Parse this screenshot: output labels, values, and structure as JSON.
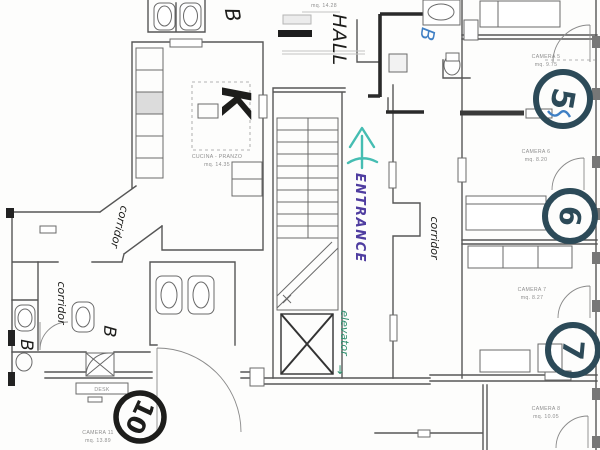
{
  "annotations": {
    "kitchen": "K",
    "hall": "HALL",
    "entrance": "ENTRANCE",
    "elevator": "elevator",
    "elevator_arrow": "↓",
    "corridor_upper": "corridor",
    "corridor_lower_left": "corridor",
    "corridor_right": "corridor",
    "bath_top_left": "B",
    "bath_top_blue": "B",
    "bath_lower_mid": "B",
    "bath_lower_left": "B"
  },
  "room_numbers": {
    "camera5": "5",
    "camera6": "6",
    "camera7": "7",
    "camera10": "10"
  },
  "printed_labels": {
    "kitchen_name": "CUCINA - PRANZO",
    "kitchen_area": "mq. 14.35",
    "hall_area": "mq. 14.28",
    "camera5_name": "CAMERA 5",
    "camera5_area": "mq. 9.75",
    "camera6_name": "CAMERA 6",
    "camera6_area": "mq. 8.20",
    "camera7_name": "CAMERA 7",
    "camera7_area": "mq. 8.27",
    "camera8_name": "CAMERA 8",
    "camera8_area": "mq. 10.05",
    "camera11_name": "CAMERA 11",
    "camera11_area": "mq. 13.89",
    "desk": "DESK"
  },
  "colors": {
    "ink_black": "#1d1d1b",
    "ink_navy": "#2c4a58",
    "ink_blue": "#3f7fc4",
    "ink_purple": "#4f3da0",
    "ink_teal": "#45bdb2",
    "ink_green": "#2f8f6e",
    "print": "#8f8f8f"
  }
}
